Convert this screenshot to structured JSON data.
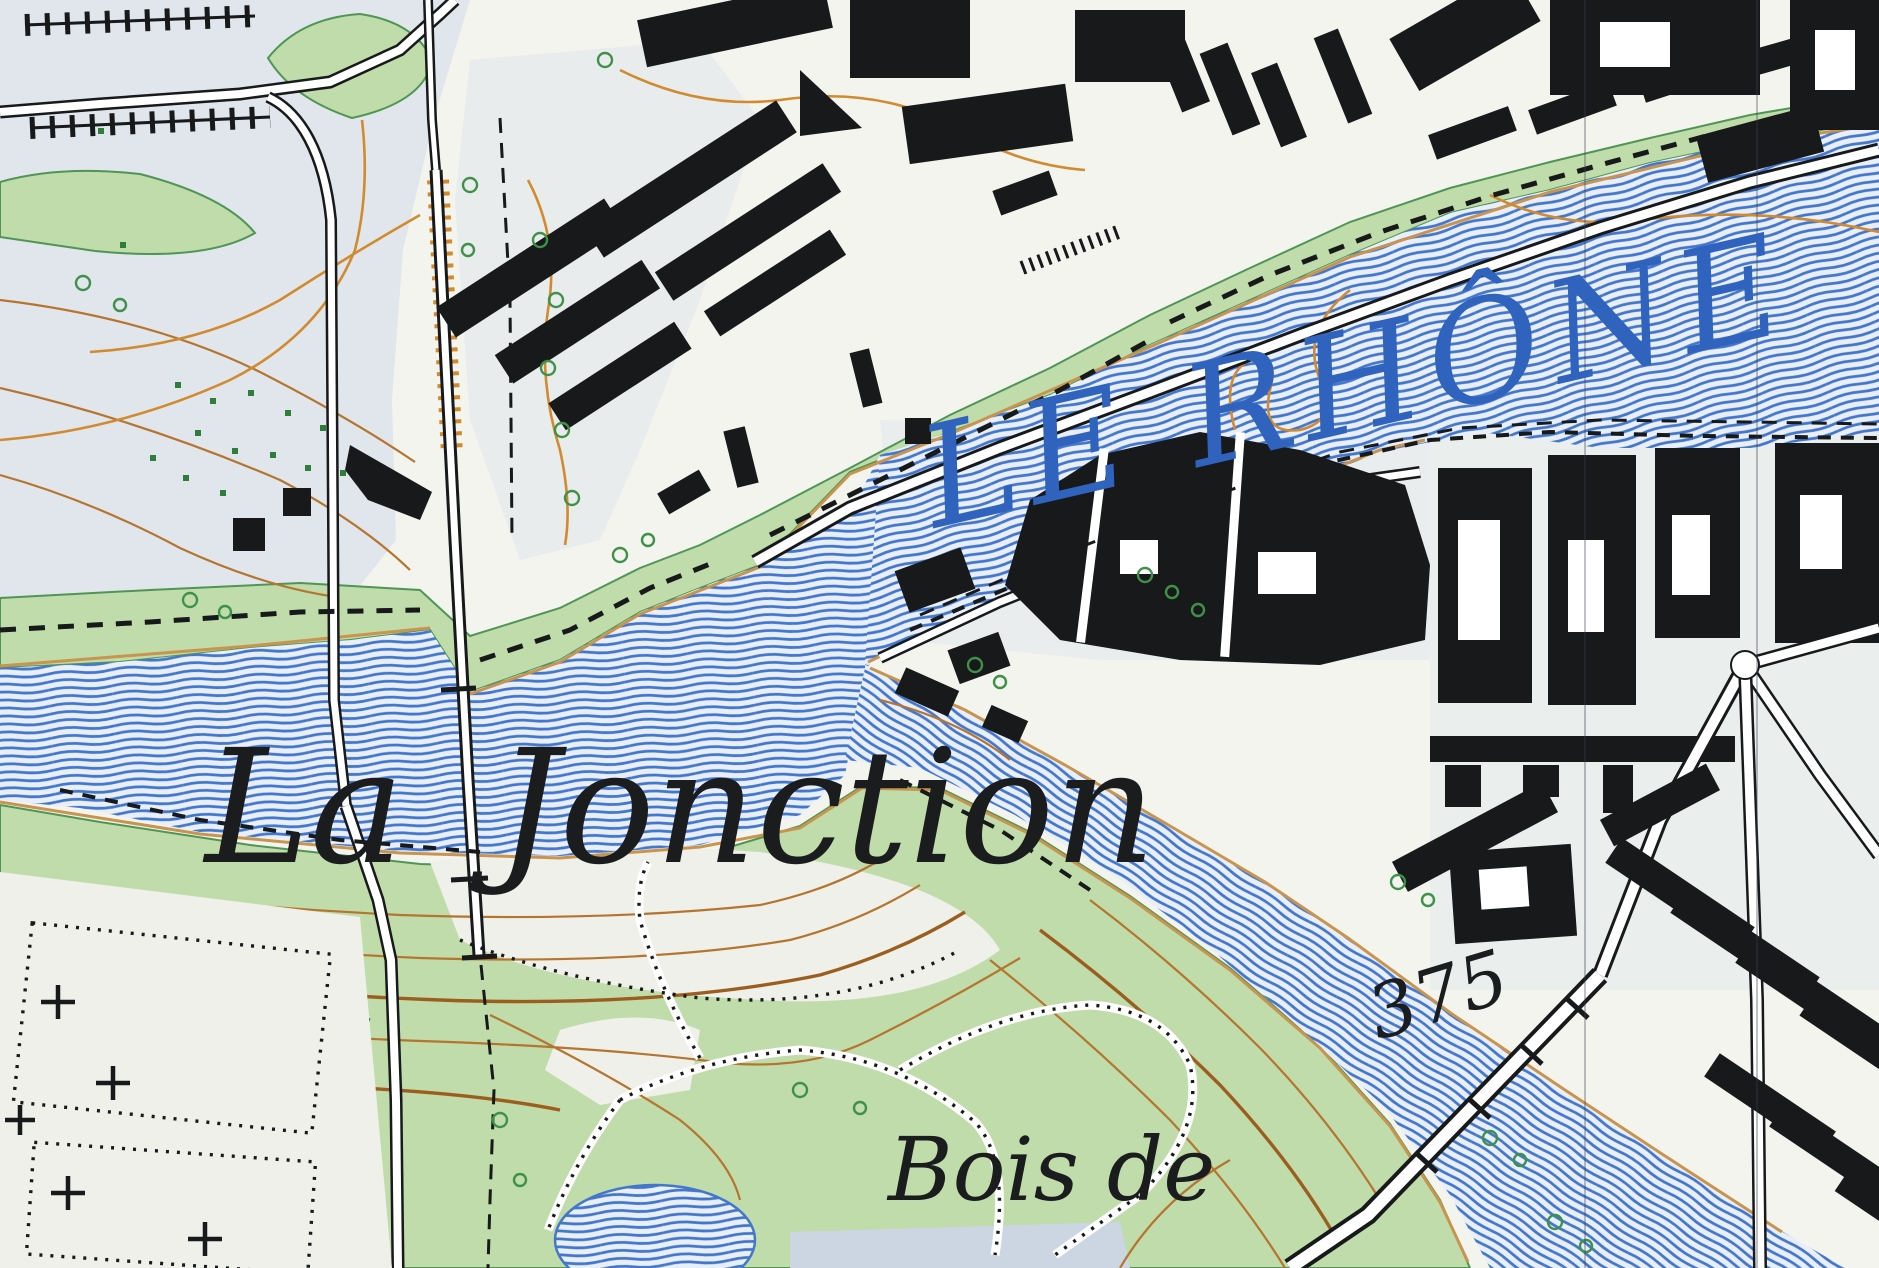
{
  "map": {
    "title": "Swiss topographic map extract — confluence of the Rhône and Arve",
    "labels": {
      "river_main": "LE RHÔNE",
      "place": "La Jonction",
      "woods": "Bois de",
      "spot_elevation": "375"
    },
    "features": [
      "rhone-river",
      "arve-river",
      "confluence-point",
      "railway-viaduct",
      "north-bank-greenbelt",
      "south-slope-woods",
      "bois-de-la-batie-park",
      "cemetery",
      "city-blocks",
      "factory-block",
      "arve-road-bridge",
      "pond",
      "contour-lines",
      "tree-symbols",
      "grid-hairlines"
    ],
    "colors": {
      "paper": "#f3f4ee",
      "tint": "#e0e6ec",
      "grayblue": "#ccd6e2",
      "clearing": "#eef0e9",
      "water_bg": "#e9effa",
      "water_line": "#4377cc",
      "water_text": "#2f63bd",
      "green": "#bfdcaa",
      "green_edge": "#4e9556",
      "contour": "#b5752e",
      "contour_index": "#9c5e1f",
      "tan": "#c8944e",
      "orange": "#d18a2e",
      "building": "#17191b",
      "tree": "#3f9149",
      "scrub": "#2e7d3a",
      "label": "#1a1c1e"
    }
  }
}
